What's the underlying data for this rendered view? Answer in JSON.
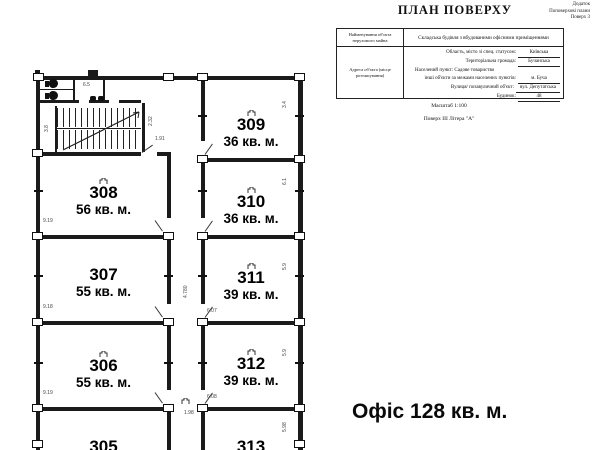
{
  "header": {
    "title": "ПЛАН ПОВЕРХУ",
    "note": [
      "Додаток",
      "Поповерхові плани",
      "Поверх 3"
    ]
  },
  "info_table": {
    "row1_label": "Найменування об'єкта нерухомого майна",
    "row1_value": "Складська будівля з вбудованими офісними приміщеннями",
    "row2_label": "Адреса об'єкта (місце розташування)",
    "address": {
      "line1_label": "Область, місто зі спец. статусом:",
      "line1_value": "Київська",
      "line2_label": "Територіальна громада:",
      "line2_value": "Бучанська",
      "line3": "Населений пункт: Садове товариство",
      "line4_label": "інші об'єкти за межами населених пунктів:",
      "line4_value": "м. Буча",
      "line5_label": "Вулиця/ позавуличний об'єкт:",
      "line5_value": "вул. Депутатська",
      "line6_label": "Будинок:",
      "line6_value": "48"
    }
  },
  "scale_label": "Масштаб 1:100",
  "floor_label": "Поверх ІІІ Літера \"А\"",
  "office_label": "Офіс 128 кв. м.",
  "rooms": [
    {
      "number": "308",
      "area": "56 кв. м."
    },
    {
      "number": "307",
      "area": "55 кв. м."
    },
    {
      "number": "306",
      "area": "55 кв. м."
    },
    {
      "number": "305",
      "area": ""
    },
    {
      "number": "309",
      "area": "36 кв. м."
    },
    {
      "number": "310",
      "area": "36 кв. м."
    },
    {
      "number": "311",
      "area": "39 кв. м."
    },
    {
      "number": "312",
      "area": "39 кв. м."
    },
    {
      "number": "313",
      "area": ""
    }
  ],
  "dims": {
    "room308_w": "9.19",
    "room307_w": "9.18",
    "room306_w": "9.19",
    "r311_w": "6.07",
    "r312_w": "6.08",
    "r309_h": "3.4",
    "r310_h": "6.1",
    "r311_h": "5.9",
    "r312_h": "5.9",
    "r313_h": "5.98",
    "corridor_h": "4.780",
    "corridor_w": "1.98",
    "hall_a": "2.32",
    "hall_b": "1.91",
    "stairs": "3.8",
    "wc": "6.5"
  }
}
